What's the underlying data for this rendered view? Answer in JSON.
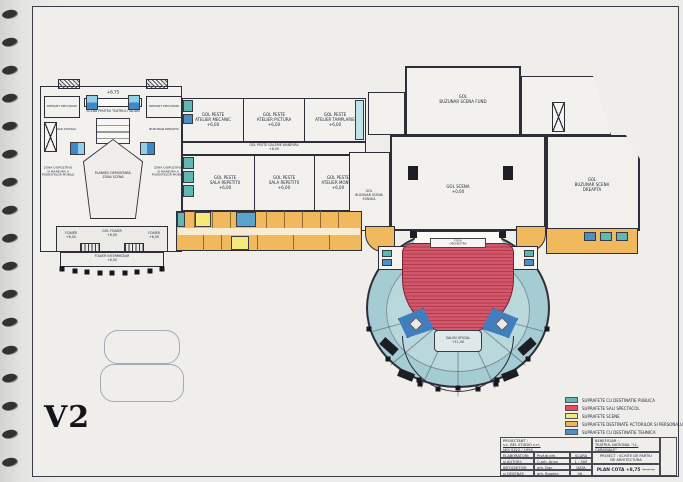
{
  "page": {
    "version_label": "V2"
  },
  "legend": {
    "items": [
      {
        "label": "SUPRAFETE CU DESTINATIE PUBLICA",
        "color": "#5fb7b4"
      },
      {
        "label": "SUPRAFETE SALI SPECTACOL",
        "color": "#e8485e"
      },
      {
        "label": "SUPRAFETE SCENE",
        "color": "#f6e97c"
      },
      {
        "label": "SUPRAFETE DESTINATE ACTORILOR SI PERSONALULUI",
        "color": "#f2b457"
      },
      {
        "label": "SUPRAFETE CU DESTINATIE TEHNICA",
        "color": "#4d8fc4"
      }
    ]
  },
  "title_block": {
    "proiectant_label": "PROIECTANT :",
    "proiectant_name": "s.c. BEL STUDIO s.r.l.",
    "proiectant_reg": "J40/ 5322 / 1994",
    "beneficiar_label": "BENEFICIAR :",
    "beneficiar_name": "TEATRUL NATIONAL \"I.L. CARAGIALE\"",
    "beneficiar_addr": "BUCURESTI, B-dul N. Balcescu",
    "rows": [
      {
        "role": "ELABORATORI:",
        "name": "Prof.dr.arh. Romeo BELEA"
      },
      {
        "role": "si AUTORI:",
        "name": "C.arh. Anca TEODORU"
      },
      {
        "role": "INTOCMITOR:",
        "name": "arh. Dan ENACHE"
      },
      {
        "role": "si DESENAT:",
        "name": "arh. Bogdan CRACIUN"
      }
    ],
    "scara_label": "SCARA",
    "scara_value": "1 : 500",
    "data_label": "DATA",
    "data_value": "06 - 2007",
    "proiect_line1": "PROIECT : SCHITE DE PARTIU",
    "proiect_line2": "DE ARHITECTURA",
    "plan_cota": "PLAN COTA +8,75 ——— +11,00"
  },
  "plan": {
    "rooms": {
      "atelier_mecanic": "GOL PESTE\nATELIER MECANIC\n+6,00",
      "atelier_pictura": "GOL PESTE\nATELIER PICTURA\n+6,00",
      "atelier_tamplarie": "GOL PESTE\nATELIER TAMPLARIE\n+6,00",
      "galerie_manevra": "GOL PESTE GALERIE MANEVRA\n+6,00",
      "sala_repetitii": "GOL PESTE\nSALA REPETITII\n+6,00",
      "atelier_montaj": "GOL PESTE\nATELIER MONTAJ\n+6,00",
      "buzunar_fund": "GOL\nBUZUNAR SCENA FUND",
      "scena": "GOL SCENA\n+0,00",
      "buzunar_stanga": "GOL\nBUZUNAR SCENA\nSTANGA",
      "buzunar_dreapta": "GOL\nBUZUNAR SCENA\nDREAPTA",
      "cota_stage": "+6,75",
      "scena_italiana": "SCENA PENTRU TEATRUL ITALIAN",
      "depozit": "DEPOZIT DECORURI",
      "buzunar_st": "BUZUNAR STANGA",
      "buzunar_dr": "BUZUNAR DREAPTA",
      "planseu": "PLANSEU DEMONTABIL\nZONA SCENA",
      "zona_dispozitive": "ZONA DISPOZITIVE\nSI MANEVRA A\nPODESTELOR MOBILE",
      "foaier": "FOAIER\n+6,00",
      "gol_foaier": "GOL FOAIER\n+6,00",
      "foaier_intermediar": "FOAIER INTERMEDIAR\n+6,00",
      "fosa_orchestra": "FOSA\nORCHESTRA",
      "salon_oficial": "SALON OFICIAL\n+11,00"
    }
  }
}
